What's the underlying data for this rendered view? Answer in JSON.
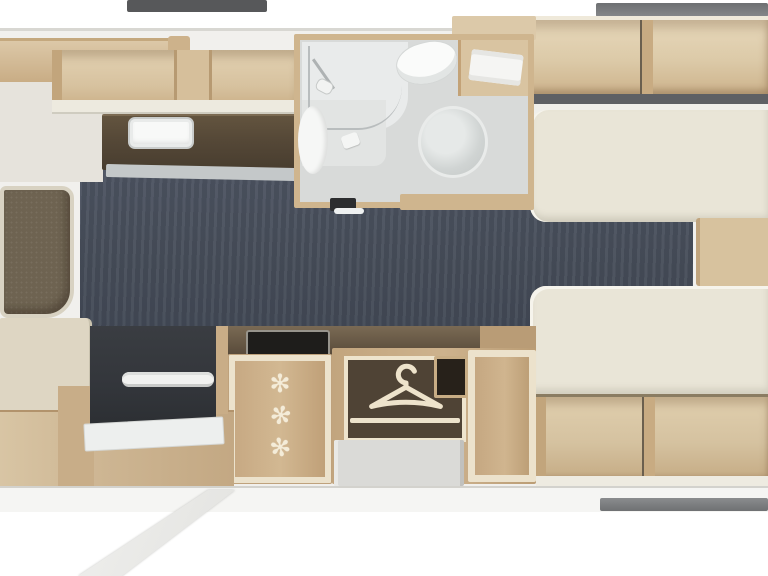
{
  "meta": {
    "type": "caravan-floorplan-top-view",
    "orientation": "horizontal",
    "has_text": false
  },
  "palette": {
    "exterior": "#ffffff",
    "wall": "#f1f0ed",
    "window_dark": "#57585a",
    "window_light": "#7d7f82",
    "wood_light": "#dcc8a8",
    "wood_mid": "#c9ad85",
    "wood_dark": "#b2936c",
    "worktop_brown": "#554837",
    "floor_dark": "#464d59",
    "upholstery_olive": "#6e6351",
    "bed_cream": "#e9e5d7",
    "bathroom_floor": "#d8dad9",
    "fixture_white": "#f8f9f8",
    "wardrobe_interior": "#4f4335",
    "entry_door_dark": "#33363b",
    "icon_cream": "#f4ecd8"
  },
  "rooms": {
    "kitchen": {
      "name": "kitchen",
      "features": [
        "overhead-lockers",
        "worktop",
        "sink",
        "hob"
      ]
    },
    "washroom": {
      "name": "washroom",
      "features": [
        "shower",
        "washbasin",
        "vanity",
        "toilet"
      ]
    },
    "bedroom": {
      "name": "twin-single-beds",
      "features": [
        "bed-top",
        "bed-bottom",
        "overhead-lockers",
        "bedside-step",
        "under-bed-lockers"
      ]
    },
    "lounge": {
      "name": "front-lounge",
      "features": [
        "upholstered-seat",
        "chest"
      ]
    },
    "midships": {
      "name": "fridge-and-wardrobe",
      "features": [
        "fridge-freezer",
        "wardrobe-hanging-rail",
        "storage-locker"
      ]
    },
    "entrance": {
      "name": "entrance",
      "features": [
        "entry-door",
        "grab-handle",
        "door-mat",
        "fold-out-step"
      ]
    }
  },
  "icons": {
    "snowflake": {
      "name": "snowflake-icon",
      "glyph": "✻",
      "count": 3
    },
    "hanger": {
      "name": "hanger-icon",
      "type": "svg"
    }
  },
  "windows": {
    "top_left": 1,
    "top_right": 1,
    "bottom_right": 1
  }
}
